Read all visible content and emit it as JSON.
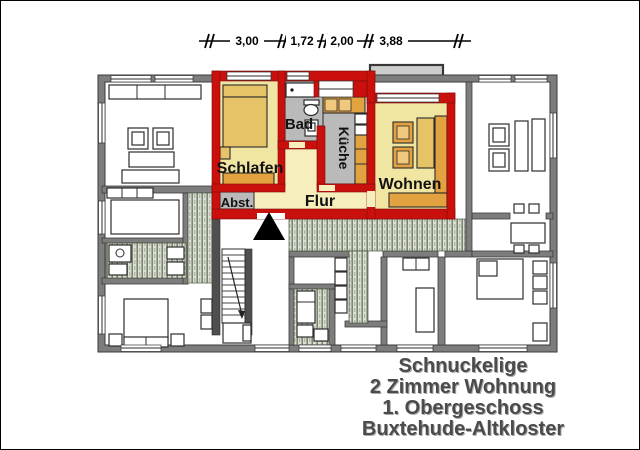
{
  "header": {
    "dimension_labels": [
      "3,00",
      "1,72",
      "2,00",
      "3,88"
    ]
  },
  "rooms": {
    "balkon": "Balkon",
    "bad": "Bad",
    "kueche": "Küche",
    "schlafen": "Schlafen",
    "wohnen": "Wohnen",
    "flur": "Flur",
    "abstellraum": "Abst."
  },
  "title_block": {
    "line1": "Schnuckelige",
    "line2": "2 Zimmer Wohnung",
    "line3": "1. Obergeschoss",
    "line4": "Buxtehude-Altkloster"
  },
  "icons": {
    "entrance_marker": "entrance-triangle"
  },
  "colors": {
    "wall_red": "#c9100d",
    "wall_gray": "#7d7d7d",
    "wall_dark": "#4f4f4f",
    "room_cream": "#f1e5a2",
    "flur_cream": "#f6eebd",
    "furn_gold": "#e5c366",
    "furn_orange": "#e2a240",
    "furn_orange_light": "#f0c87e",
    "floor_gray": "#bababa",
    "balcony_gray": "#cdcdcd",
    "hatch_bg": "#dce0d4",
    "hatch_line": "#75816d",
    "title_text": "#4b4b4b"
  }
}
